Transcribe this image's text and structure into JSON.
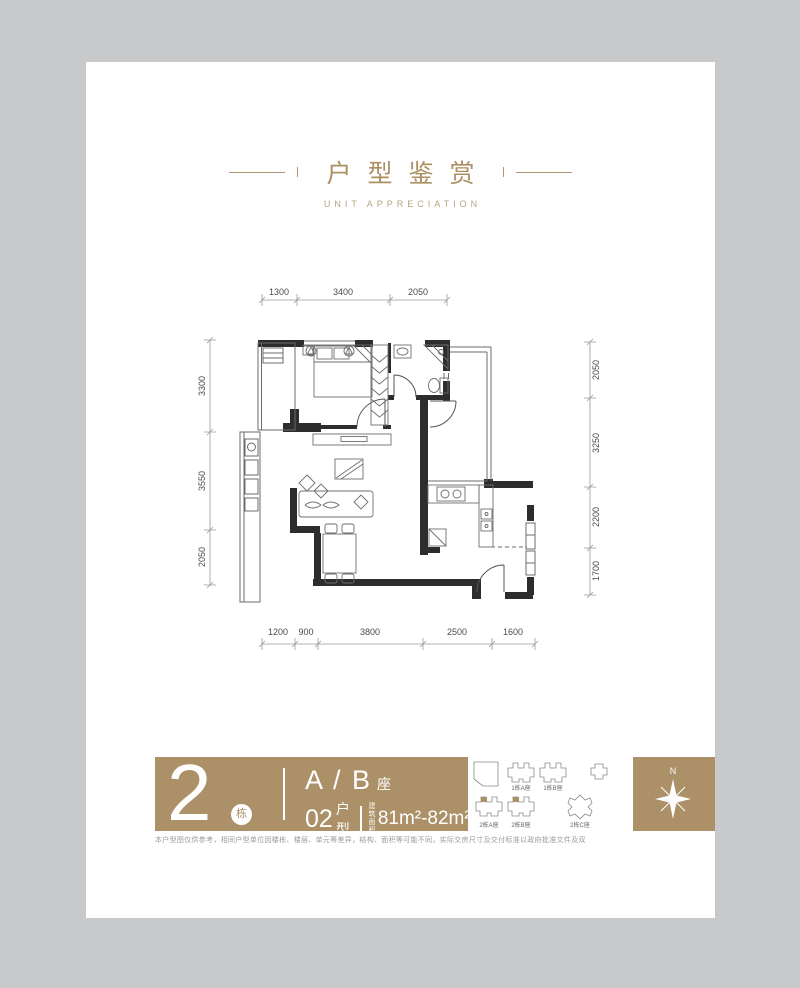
{
  "header": {
    "title": "户型鉴赏",
    "subtitle": "UNIT APPRECIATION",
    "accent": "#ac8f63"
  },
  "plan": {
    "dims": {
      "top": [
        "1300",
        "3400",
        "2050"
      ],
      "left": [
        "3300",
        "3550",
        "2050"
      ],
      "right": [
        "2050",
        "3250",
        "2200",
        "1700"
      ],
      "bottom": [
        "1200",
        "900",
        "3800",
        "2500",
        "1600"
      ]
    }
  },
  "info": {
    "building_number": "2",
    "building_suffix": "栋",
    "block_name": "A / B",
    "block_suffix": "座",
    "unit_number": "02",
    "unit_suffix": "户型",
    "area_label_line1": "建筑",
    "area_label_line2": "面积",
    "area_value": "81m²-82m²",
    "bar_color": "#ab9068"
  },
  "siteplan": {
    "labels": [
      "1栋A座",
      "1栋B座",
      "2栋A座",
      "2栋B座",
      "2栋C座"
    ]
  },
  "compass": {
    "north": "N"
  },
  "footer": {
    "disclaimer": "本户型图仅供参考，相同户型单位因楼栋、楼层、单元等差异，结构、面积等可能不同，实际交房尺寸及交付标准以政府批准文件及双方签订的商品房买卖合同为准。"
  }
}
